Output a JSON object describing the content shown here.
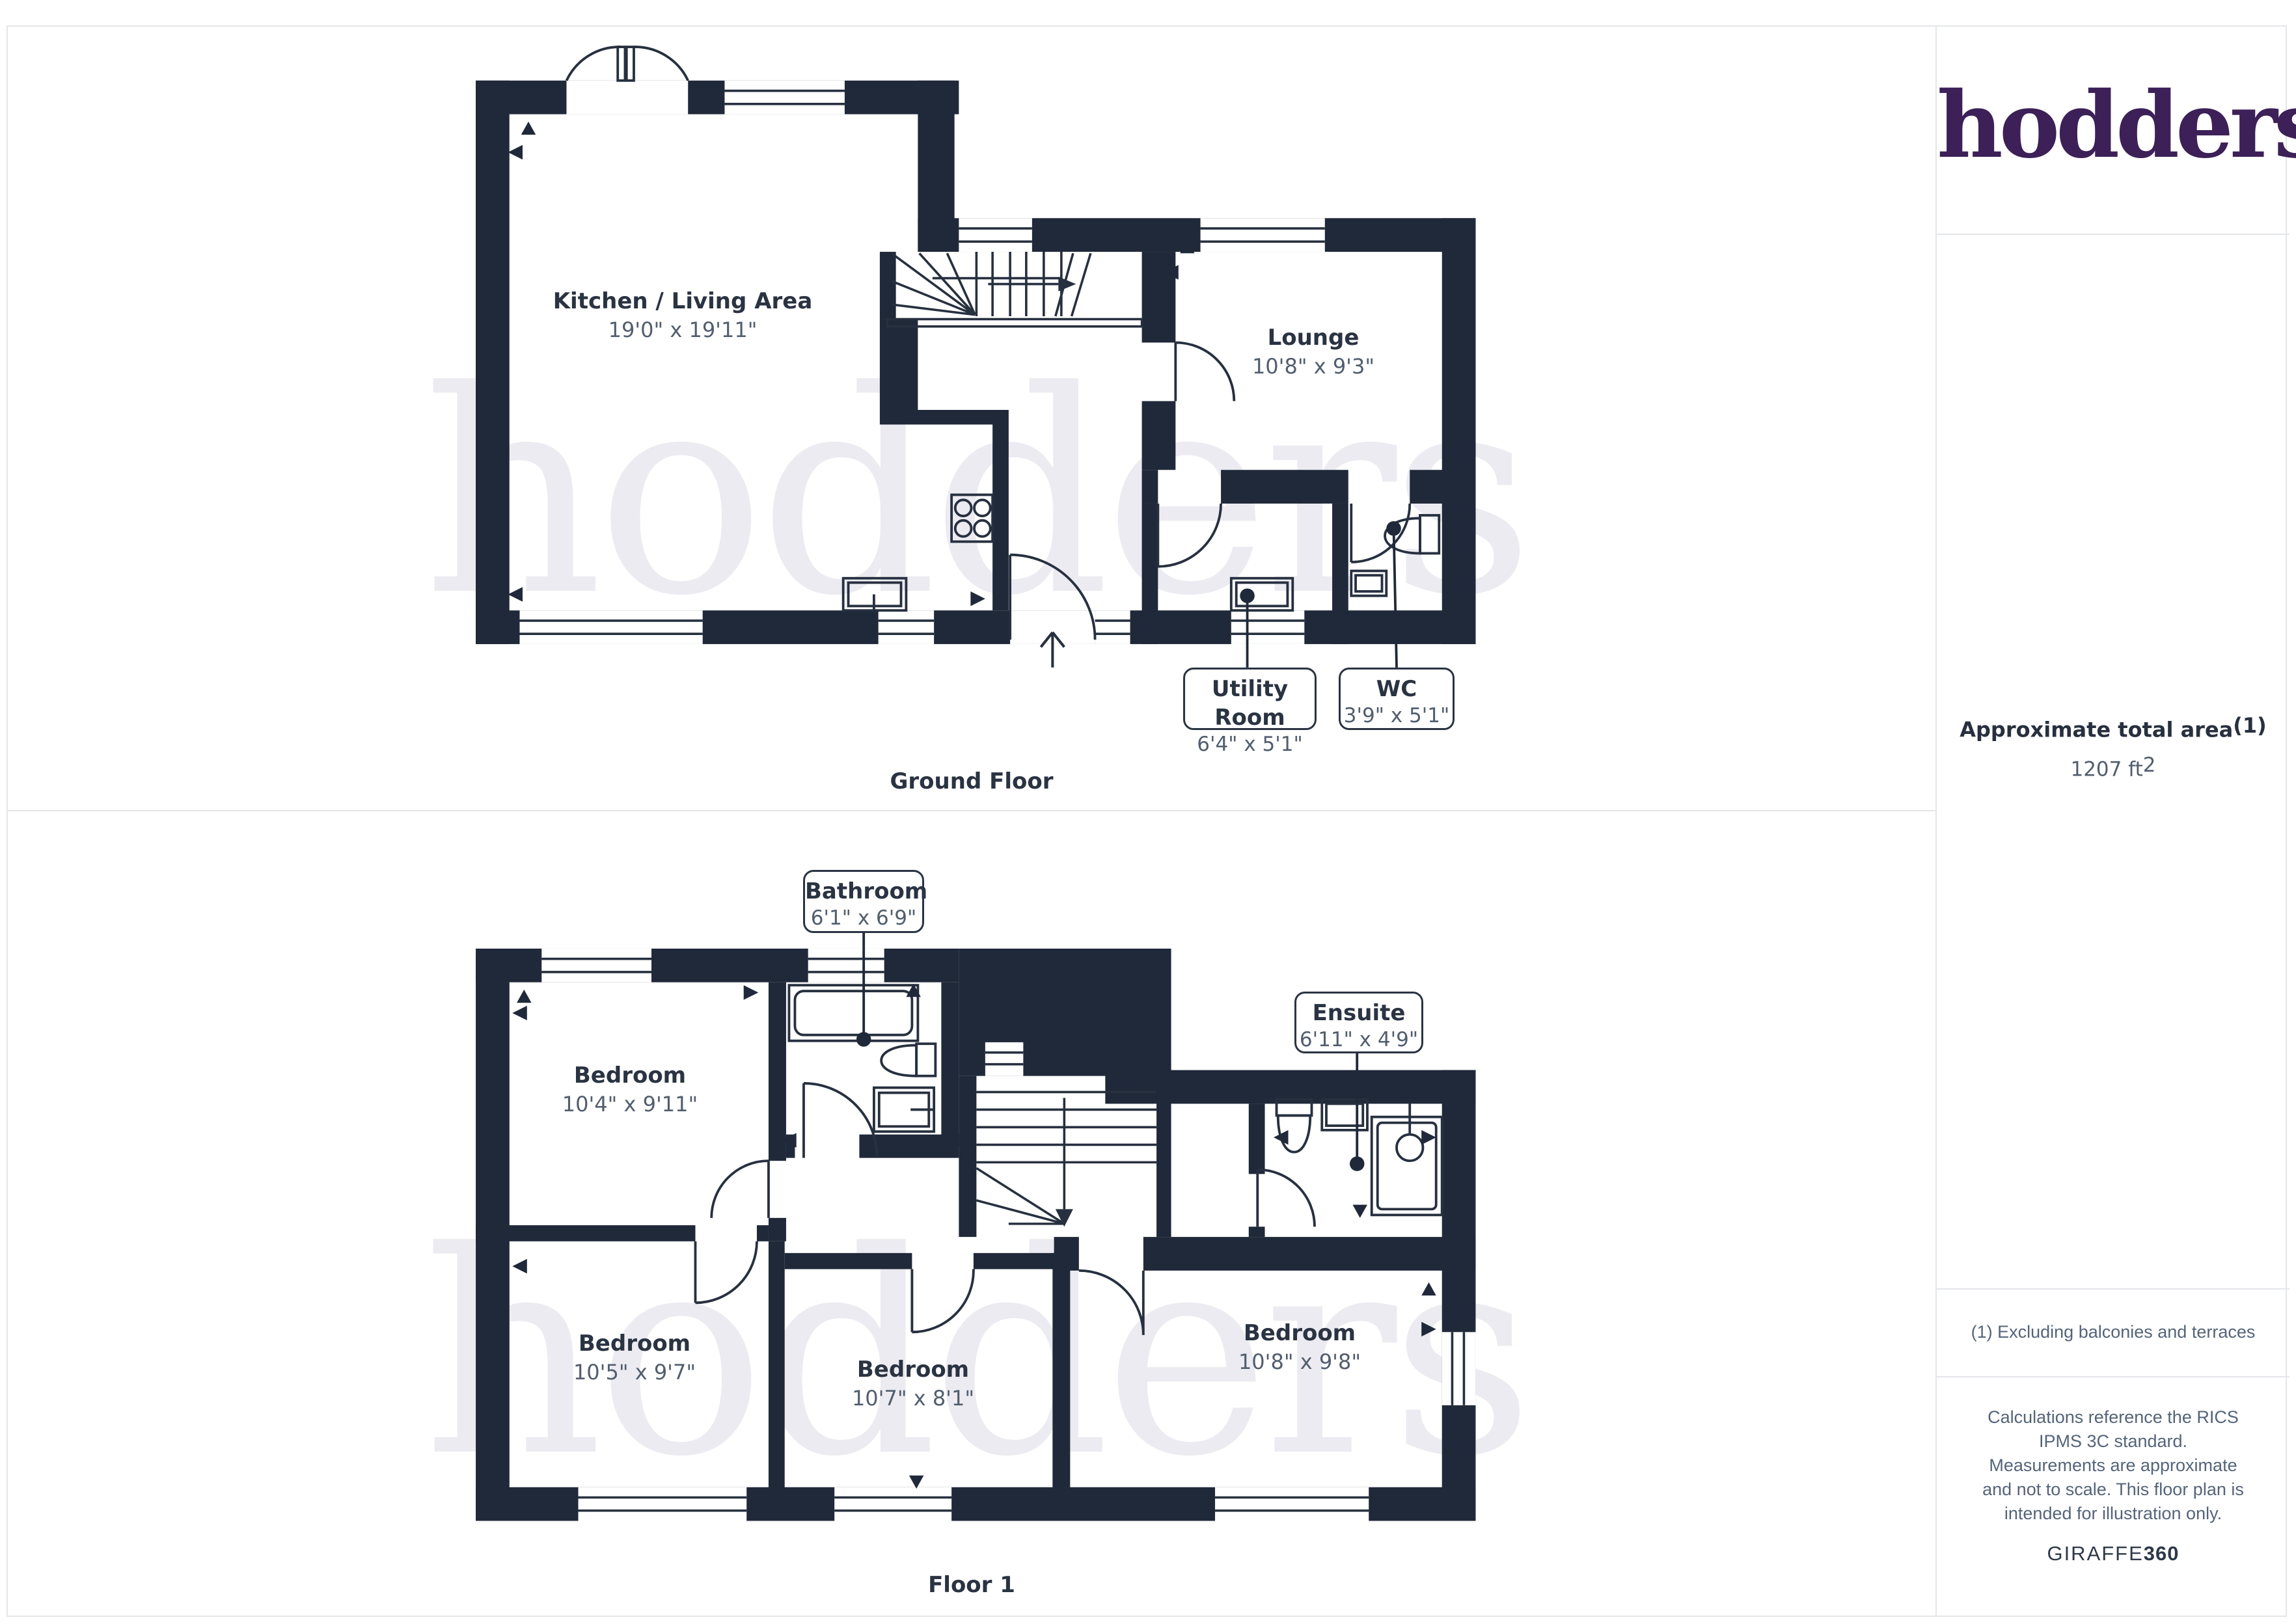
{
  "branding": {
    "logo": "hodders",
    "watermark": "hodders",
    "provider_light": "GIRAFFE",
    "provider_bold": "360"
  },
  "ground_floor": {
    "label": "Ground Floor",
    "kitchen": {
      "name": "Kitchen / Living Area",
      "dims": "19'0\" x 19'11\""
    },
    "lounge": {
      "name": "Lounge",
      "dims": "10'8\" x 9'3\""
    },
    "utility": {
      "name": "Utility Room",
      "dims": "6'4\" x 5'1\""
    },
    "wc": {
      "name": "WC",
      "dims": "3'9\" x 5'1\""
    }
  },
  "floor1": {
    "label": "Floor 1",
    "bathroom": {
      "name": "Bathroom",
      "dims": "6'1\" x 6'9\""
    },
    "ensuite": {
      "name": "Ensuite",
      "dims": "6'11\" x 4'9\""
    },
    "bedroom_top_left": {
      "name": "Bedroom",
      "dims": "10'4\" x 9'11\""
    },
    "bedroom_bottom_left": {
      "name": "Bedroom",
      "dims": "10'5\" x 9'7\""
    },
    "bedroom_middle": {
      "name": "Bedroom",
      "dims": "10'7\" x 8'1\""
    },
    "bedroom_right": {
      "name": "Bedroom",
      "dims": "10'8\" x 9'8\""
    }
  },
  "sidebar": {
    "area_title": "Approximate total area",
    "area_sup": "(1)",
    "area_value": "1207 ft",
    "area_value_sup": "2",
    "footnote": "(1) Excluding balconies and terraces",
    "disclaimer": "Calculations reference the RICS IPMS 3C standard. Measurements are approximate and not to scale. This floor plan is intended for illustration only."
  },
  "colors": {
    "wall": "#202939",
    "line": "#27303F",
    "room_name": "#2A3342",
    "dims_text": "#525E6E",
    "logo_purple": "#3C2057",
    "watermark": "#ECEBF1",
    "frame_border": "#E4E6E9"
  }
}
